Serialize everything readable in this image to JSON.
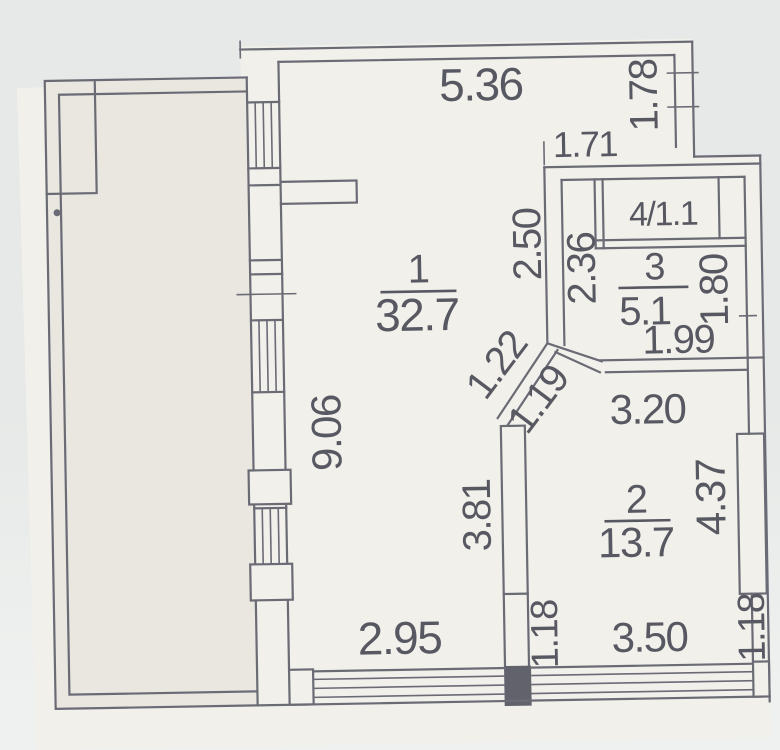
{
  "colors": {
    "background": "#e7e9e8",
    "background_bottom": "#eff1f0",
    "paper": "#f1f0ea",
    "balcony": "#e9e7df",
    "line": "#6b6b77",
    "wall_dark": "#62626e",
    "text": "#585862"
  },
  "rooms": {
    "room1": {
      "number": "1",
      "area": "32.7"
    },
    "room2": {
      "number": "2",
      "area": "13.7"
    },
    "room3": {
      "number": "3",
      "area": "5.1"
    },
    "room4": {
      "label": "4/1.1"
    }
  },
  "dimensions": {
    "top_width": "5.36",
    "right_upper_height": "1.78",
    "entry_top_width": "1.71",
    "room1_right_upper": "2.50",
    "room3_left_height": "2.36",
    "room3_right_height": "1.80",
    "room3_bottom_width": "1.99",
    "diagonal_upper": "1.22",
    "diagonal_lower": "1.19",
    "room2_top_width": "3.20",
    "room1_left_height": "9.06",
    "room1_right_lower": "3.81",
    "room2_right_height": "4.37",
    "room1_bottom_width": "2.95",
    "bottom_wall_left": "1.18",
    "room2_bottom_width": "3.50",
    "bottom_wall_right": "1.18"
  }
}
